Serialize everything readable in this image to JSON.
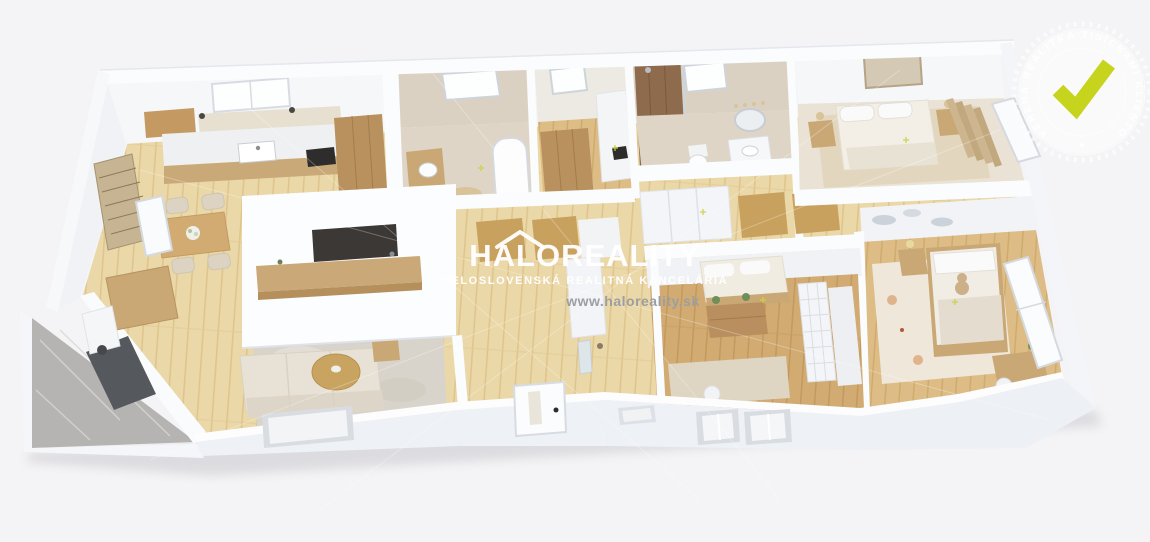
{
  "watermark": {
    "brand": "HALOREALITY",
    "tagline": "CELOSLOVENSKÁ REALITNÁ KANCELÁRIA",
    "website": "www.haloreality.sk"
  },
  "badge": {
    "arc_text": "OVERENÁ REALITKA TISÍCKAMI KLIENTOV",
    "star": "✶"
  },
  "colors": {
    "background": "#f4f4f6",
    "check_accent": "#c6d41e",
    "watermark_text": "#ffffff",
    "website_text": "#9c9ea1",
    "wall_white": "#f8f9fb",
    "wood_light": "#ebd8a8",
    "wood_medium": "#d6b176",
    "tile_beige": "#ded5c6",
    "balcony_stone": "#b6b4b2"
  },
  "scene": {
    "type": "3d-floorplan-render",
    "rooms": [
      "kitchen-dining",
      "living-room",
      "balcony",
      "bathroom-with-tub",
      "closet",
      "bathroom-with-shower",
      "hallway",
      "entry",
      "master-bedroom",
      "second-bedroom",
      "kids-room"
    ]
  }
}
